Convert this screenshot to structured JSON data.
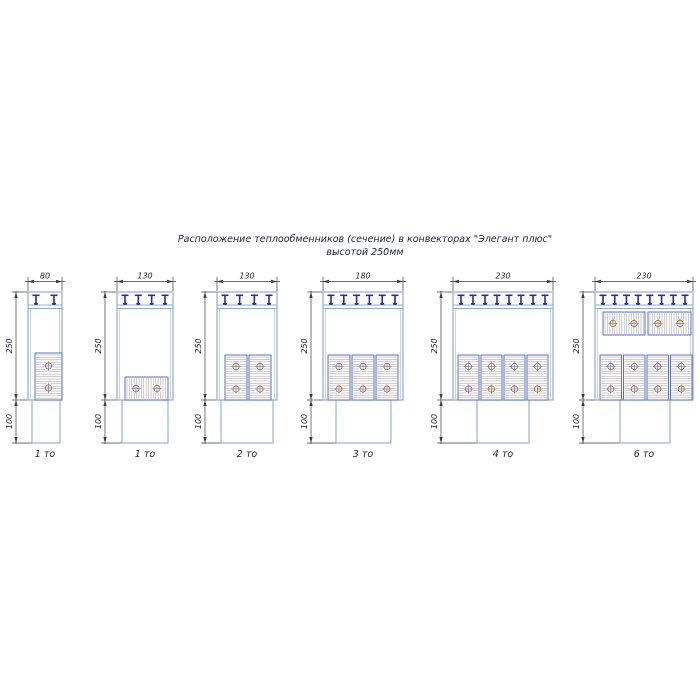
{
  "title": {
    "line1": "Расположение теплообменников (сечение) в конвекторах \"Элегант плюс\"",
    "line2": "высотой 250мм"
  },
  "colors": {
    "box": "#94aad6",
    "boxInner": "#bcc9e6",
    "tooth": "#2b2b9e",
    "block": "#5f6fc5",
    "blockFill": "#fbfbfb",
    "hatch": "#a3a3a3",
    "circle": "#b0713d",
    "cross": "#4a5ab0",
    "dim": "#3d3d3d",
    "text": "#23233c"
  },
  "dims": {
    "height_label": "250",
    "lower_label": "100"
  },
  "diagrams": [
    {
      "label": "1 то",
      "width_dim": "80",
      "box": {
        "x": 28,
        "y": 292,
        "w": 34,
        "h": 108
      },
      "lower": {
        "x": 32,
        "w": 28,
        "h": 43
      },
      "teeth": 2,
      "blocks": [
        {
          "x": 35,
          "y": 353,
          "w": 27,
          "h": 47,
          "hatch": "h",
          "circles": [
            [
              48.5,
              366
            ],
            [
              48.5,
              388
            ]
          ]
        }
      ]
    },
    {
      "label": "1 то",
      "width_dim": "130",
      "box": {
        "x": 117,
        "y": 292,
        "w": 56,
        "h": 108
      },
      "lower": {
        "x": 122,
        "w": 46,
        "h": 43
      },
      "teeth": 4,
      "blocks": [
        {
          "x": 125,
          "y": 377,
          "w": 43,
          "h": 23,
          "hatch": "v",
          "circles": [
            [
              136,
              388.5
            ],
            [
              157,
              388.5
            ]
          ]
        }
      ]
    },
    {
      "label": "2 то",
      "width_dim": "130",
      "box": {
        "x": 217,
        "y": 292,
        "w": 60,
        "h": 108
      },
      "lower": {
        "x": 221,
        "w": 52,
        "h": 43
      },
      "teeth": 4,
      "blocks": [
        {
          "x": 225,
          "y": 355,
          "w": 22,
          "h": 45,
          "hatch": "h",
          "circles": [
            [
              236,
              366.5
            ],
            [
              236,
              389
            ]
          ]
        },
        {
          "x": 249,
          "y": 355,
          "w": 22,
          "h": 45,
          "hatch": "h",
          "circles": [
            [
              260,
              366.5
            ],
            [
              260,
              389
            ]
          ]
        }
      ]
    },
    {
      "label": "3 то",
      "width_dim": "180",
      "box": {
        "x": 323,
        "y": 292,
        "w": 80,
        "h": 108
      },
      "lower": {
        "x": 336,
        "w": 55,
        "h": 43
      },
      "teeth": 6,
      "blocks": [
        {
          "x": 328,
          "y": 355,
          "w": 22,
          "h": 45,
          "hatch": "h",
          "circles": [
            [
              339,
              366.5
            ],
            [
              339,
              389
            ]
          ]
        },
        {
          "x": 352,
          "y": 355,
          "w": 22,
          "h": 45,
          "hatch": "h",
          "circles": [
            [
              363,
              366.5
            ],
            [
              363,
              389
            ]
          ]
        },
        {
          "x": 376,
          "y": 355,
          "w": 22,
          "h": 45,
          "hatch": "h",
          "circles": [
            [
              387,
              366.5
            ],
            [
              387,
              389
            ]
          ]
        }
      ]
    },
    {
      "label": "4 то",
      "width_dim": "230",
      "box": {
        "x": 453,
        "y": 292,
        "w": 100,
        "h": 108
      },
      "lower": {
        "x": 477,
        "w": 52,
        "h": 43
      },
      "teeth": 8,
      "blocks": [
        {
          "x": 458,
          "y": 355,
          "w": 21,
          "h": 45,
          "hatch": "h",
          "circles": [
            [
              468.5,
              366.5
            ],
            [
              468.5,
              389
            ]
          ]
        },
        {
          "x": 481,
          "y": 355,
          "w": 21,
          "h": 45,
          "hatch": "h",
          "circles": [
            [
              491.5,
              366.5
            ],
            [
              491.5,
              389
            ]
          ]
        },
        {
          "x": 504,
          "y": 355,
          "w": 21,
          "h": 45,
          "hatch": "h",
          "circles": [
            [
              514.5,
              366.5
            ],
            [
              514.5,
              389
            ]
          ]
        },
        {
          "x": 527,
          "y": 355,
          "w": 21,
          "h": 45,
          "hatch": "h",
          "circles": [
            [
              537.5,
              366.5
            ],
            [
              537.5,
              389
            ]
          ]
        }
      ]
    },
    {
      "label": "6 то",
      "width_dim": "230",
      "box": {
        "x": 595,
        "y": 292,
        "w": 98,
        "h": 108
      },
      "lower": {
        "x": 620,
        "w": 50,
        "h": 43
      },
      "teeth": 8,
      "blocks": [
        {
          "x": 603,
          "y": 312,
          "w": 42,
          "h": 23,
          "hatch": "v",
          "circles": [
            [
              613,
              323.5
            ],
            [
              634,
              323.5
            ]
          ]
        },
        {
          "x": 648,
          "y": 312,
          "w": 43,
          "h": 23,
          "hatch": "v",
          "circles": [
            [
              658,
              323.5
            ],
            [
              680,
              323.5
            ]
          ]
        },
        {
          "x": 600,
          "y": 355,
          "w": 21.5,
          "h": 45,
          "hatch": "h",
          "circles": [
            [
              610.8,
              366.5
            ],
            [
              610.8,
              389
            ]
          ]
        },
        {
          "x": 623.5,
          "y": 355,
          "w": 21.5,
          "h": 45,
          "hatch": "h",
          "circles": [
            [
              634.3,
              366.5
            ],
            [
              634.3,
              389
            ]
          ]
        },
        {
          "x": 647,
          "y": 355,
          "w": 21.5,
          "h": 45,
          "hatch": "h",
          "circles": [
            [
              657.8,
              366.5
            ],
            [
              657.8,
              389
            ]
          ]
        },
        {
          "x": 670.5,
          "y": 355,
          "w": 21.5,
          "h": 45,
          "hatch": "h",
          "circles": [
            [
              681.3,
              366.5
            ],
            [
              681.3,
              389
            ]
          ]
        }
      ]
    }
  ]
}
